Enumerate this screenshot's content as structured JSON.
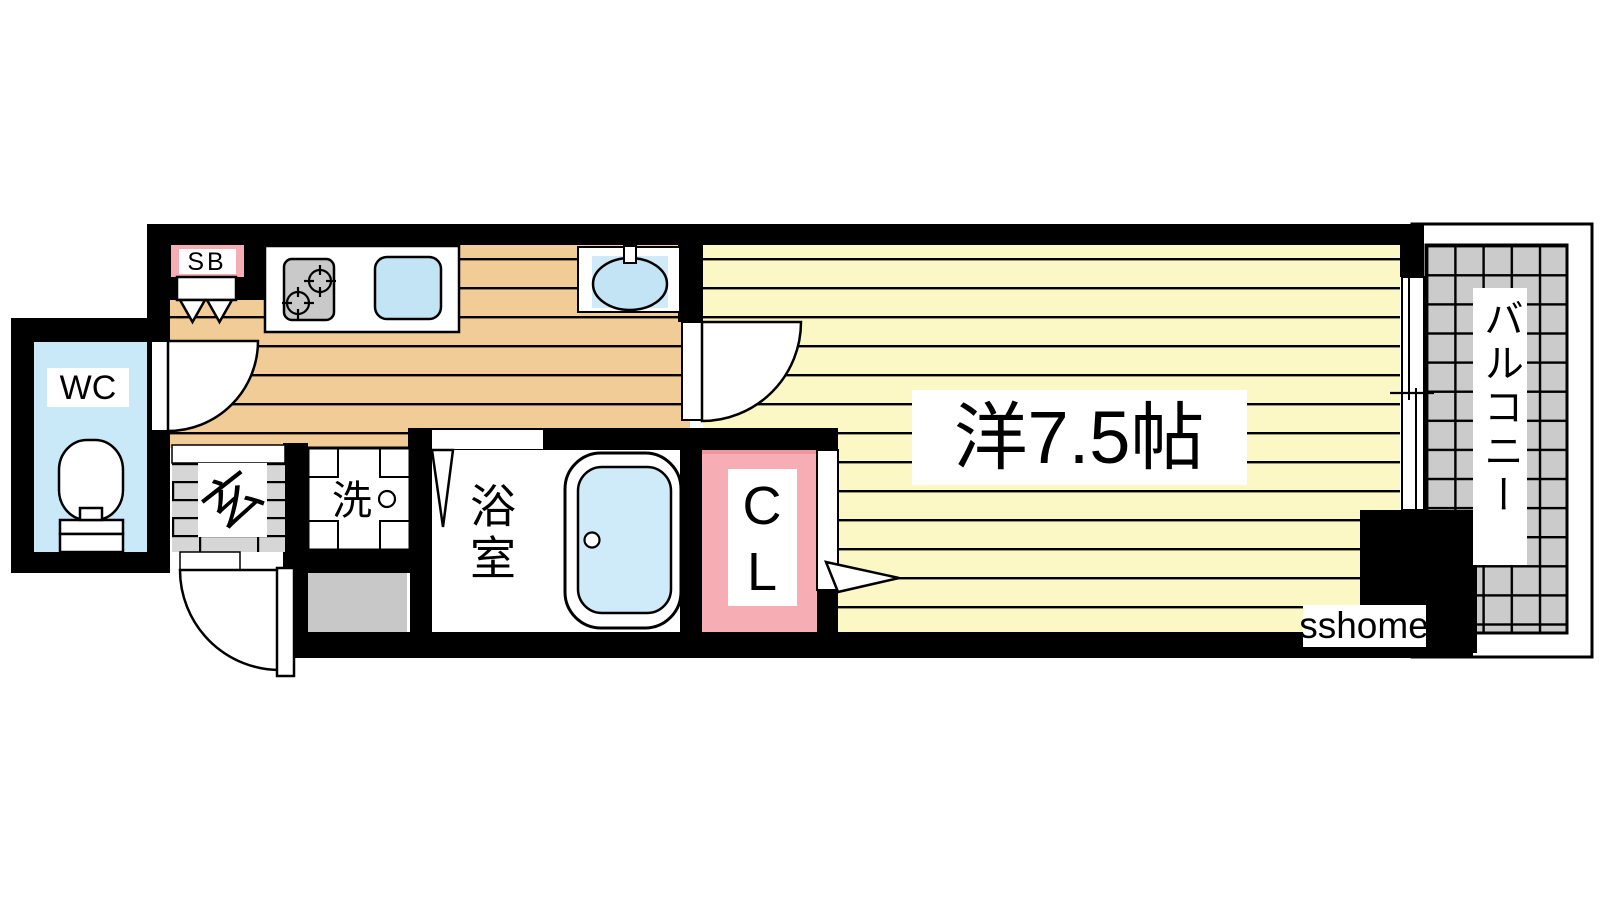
{
  "plan": {
    "labels": {
      "wc": "WC",
      "shoe_box": "SB",
      "entrance": "玄",
      "laundry": "洗",
      "bathroom": "浴室",
      "closet": "CL",
      "main_room": "洋7.5帖",
      "balcony": "バルコニー",
      "watermark": "sshome"
    },
    "colors": {
      "wall": "#000000",
      "wc_floor": "#c9e8f8",
      "hall_floor": "#f1cc96",
      "room_floor": "#fcf8c6",
      "closet_pink": "#f6aeb4",
      "closet_pink_dark": "#ec97a0",
      "sb_pink": "#f6aeb4",
      "balcony_tile": "#cbcbcb",
      "genkan_tile": "#d6d6d6",
      "meter_gray": "#c8c8c8",
      "stove_gray": "#c9c9c9",
      "fixture_blue": "#c3e4f5",
      "fixture_blue_light": "#cfeaf8",
      "watermark_text": "#1a1a1a"
    }
  }
}
